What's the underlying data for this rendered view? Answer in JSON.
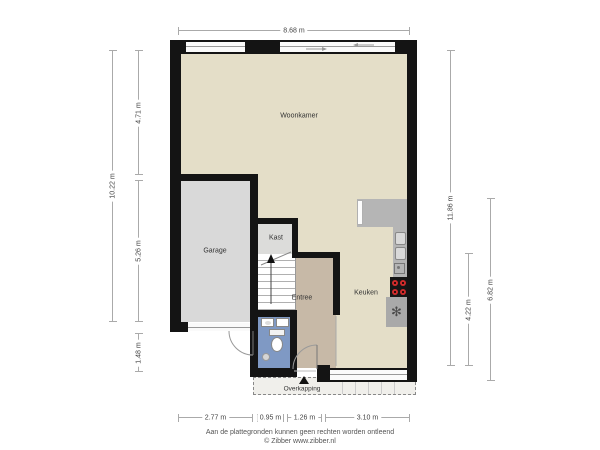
{
  "rooms": {
    "woonkamer": "Woonkamer",
    "garage": "Garage",
    "kast": "Kast",
    "entree": "Entree",
    "keuken": "Keuken",
    "overkapping": "Overkapping"
  },
  "dimensions": {
    "top": "8.68 m",
    "left_total": "10.22 m",
    "left_segments": [
      "4.71 m",
      "5.26 m",
      "1.48 m"
    ],
    "right_total": "11.86 m",
    "right_segments": [
      "4.22 m",
      "6.82 m"
    ],
    "bottom_segments": [
      "2.77 m",
      "0.95 m",
      "1.26 m",
      "3.10 m"
    ]
  },
  "footer": {
    "disclaimer": "Aan de plattegronden kunnen geen rechten worden ontleend",
    "copyright": "© Zibber www.zibber.nl"
  },
  "glyphs": {
    "ventilation": "✻"
  },
  "colors": {
    "wall": "#141414",
    "floor_living": "#e4dec8",
    "floor_garage": "#d9d9d9",
    "floor_closet": "#dcdcda",
    "floor_entree": "#c7b9a7",
    "floor_toilet": "#7f99c4",
    "counter": "#b5b5b5",
    "burner_red": "#d02b2b",
    "overkapping_fill": "#f0efeb"
  }
}
